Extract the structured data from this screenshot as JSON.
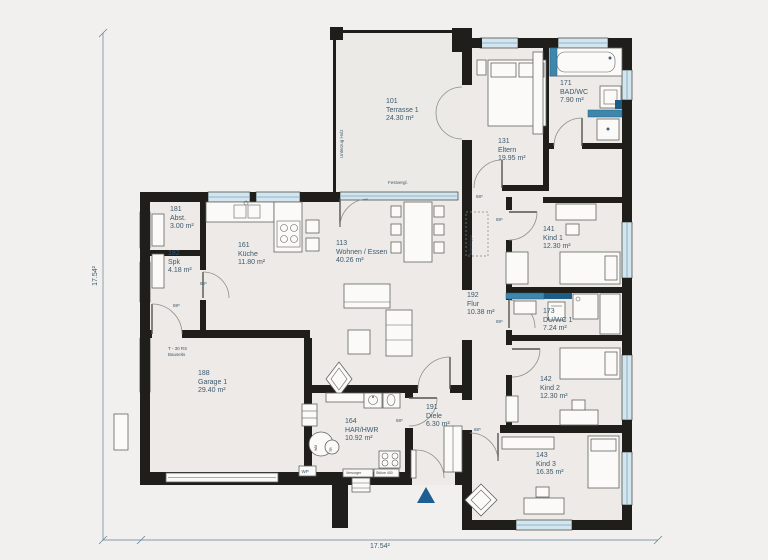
{
  "rooms": [
    {
      "number": "101",
      "name": "Terrasse 1",
      "area": "24.30 m²"
    },
    {
      "number": "131",
      "name": "Eltern",
      "area": "19.95 m²"
    },
    {
      "number": "171",
      "name": "BAD/WC",
      "area": "7.90 m²"
    },
    {
      "number": "181",
      "name": "Abst.",
      "area": "3.00 m²"
    },
    {
      "number": "182",
      "name": "Spk",
      "area": "4.18 m²"
    },
    {
      "number": "161",
      "name": "Küche",
      "area": "11.80 m²"
    },
    {
      "number": "113",
      "name": "Wohnen / Essen",
      "area": "40.26 m²"
    },
    {
      "number": "141",
      "name": "Kind 1",
      "area": "12.30 m²"
    },
    {
      "number": "192",
      "name": "Flur",
      "area": "10.38 m²"
    },
    {
      "number": "173",
      "name": "DU/WC 1",
      "area": "7.24 m²"
    },
    {
      "number": "188",
      "name": "Garage 1",
      "area": "29.40 m²"
    },
    {
      "number": "142",
      "name": "Kind 2",
      "area": "12.30 m²"
    },
    {
      "number": "164",
      "name": "HAR/HWR",
      "area": "10.92 m²"
    },
    {
      "number": "191",
      "name": "Diele",
      "area": "6.30 m²"
    },
    {
      "number": "143",
      "name": "Kind 3",
      "area": "16.35 m²"
    }
  ],
  "annotations": {
    "dim_width": "17.54²",
    "dim_height": "17.54²",
    "festvergl": "Festvergl.",
    "unterzug": "Unterzug Holz",
    "bodentreppe": "Bodentreppe",
    "fire_door_line1": "T - 30 RS",
    "fire_door_line2": "Bauseits",
    "door_size": "88⁵",
    "wp": "WP",
    "wm": "WM",
    "tr": "TR",
    "utility_left": "Versorger",
    "utility_right": "Stütze 400"
  },
  "colors": {
    "background": "#f2f0ee",
    "floor": "#edeae7",
    "wall": "#1f1e1b",
    "window": "#d3e5ee",
    "fixture_blue": "#3f86ad",
    "fixture_blue_dark": "#1d5d85",
    "text": "#3b5a6e",
    "entry_triangle": "#1e5e92"
  }
}
